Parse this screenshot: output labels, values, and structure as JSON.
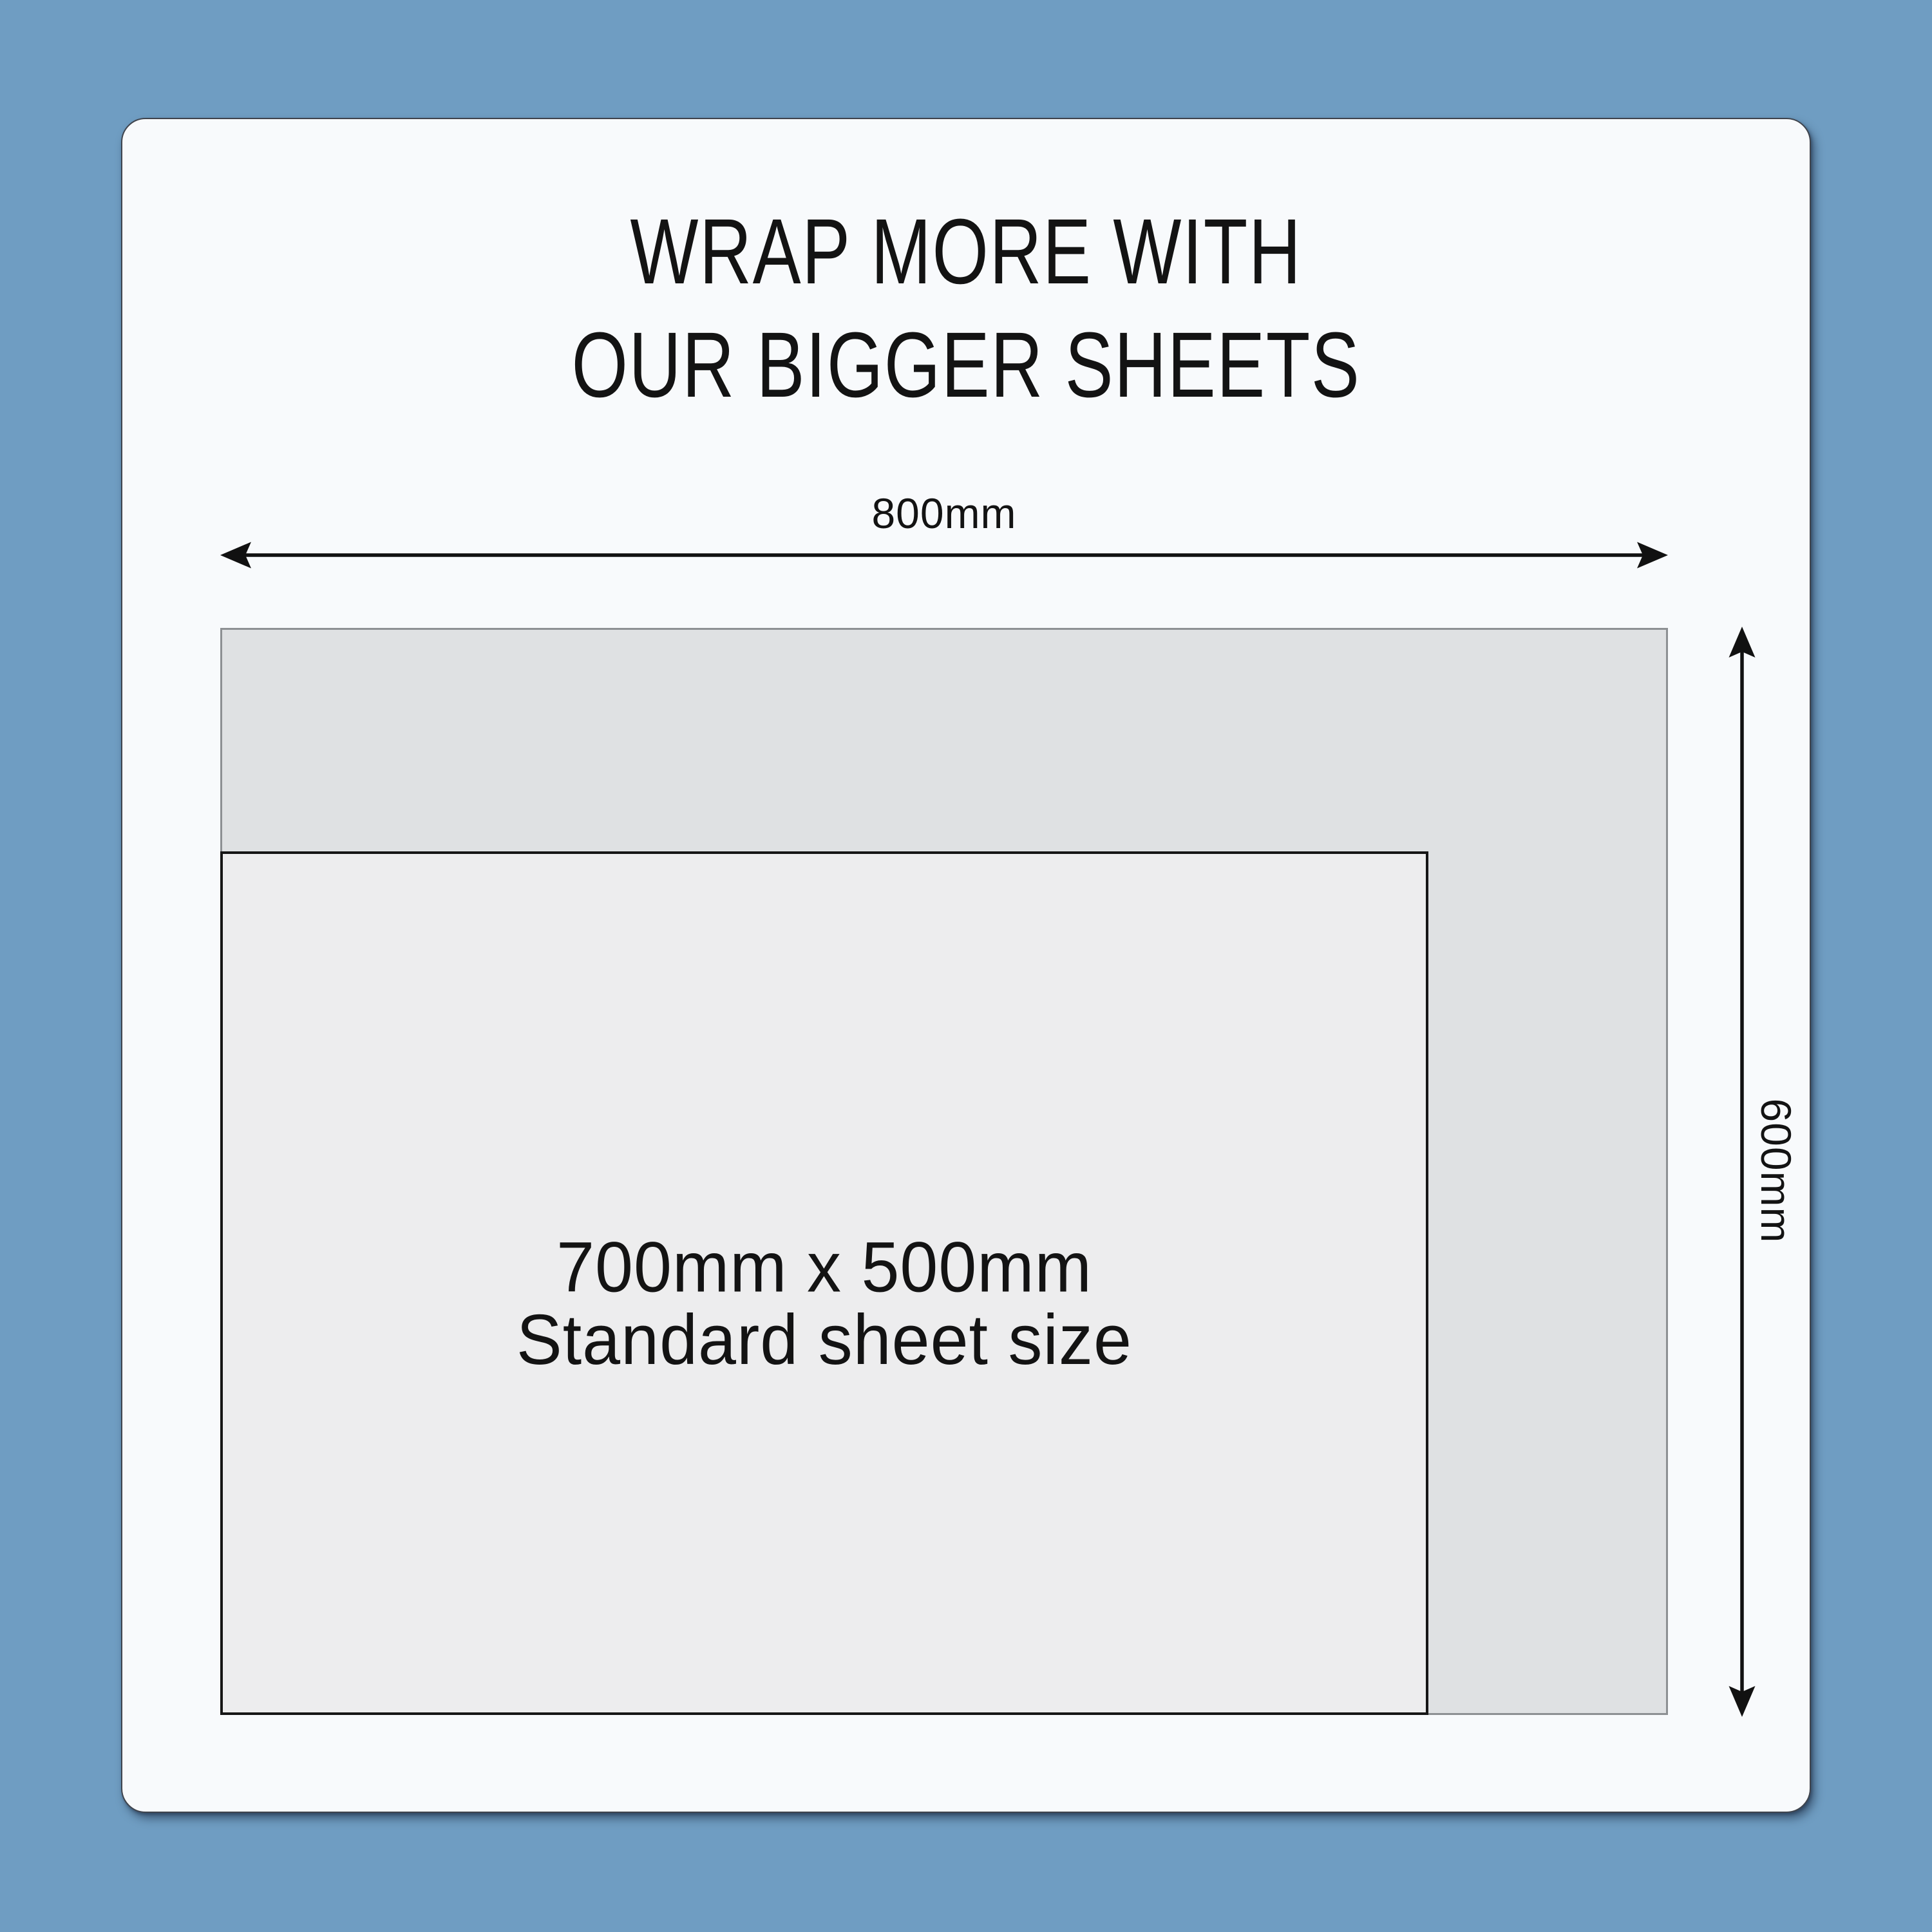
{
  "title": {
    "line1": "WRAP MORE WITH",
    "line2": "OUR BIGGER SHEETS"
  },
  "dimensions": {
    "width_label": "800mm",
    "height_label": "600mm"
  },
  "big_sheet": {
    "width_mm": "800",
    "height_mm": "600"
  },
  "standard_sheet": {
    "line1": "700mm x 500mm",
    "line2": "Standard sheet size"
  },
  "icons": {
    "horizontal_arrow": "double-headed-horizontal-dimension-arrow",
    "vertical_arrow": "double-headed-vertical-dimension-arrow"
  },
  "theme": {
    "background_blue": "#6f9dc2",
    "card_background": "#f8fafc",
    "card_border": "#3f444d",
    "big_sheet_fill": "#dfe1e3",
    "big_sheet_border": "#8d9093",
    "standard_sheet_fill": "#ededee",
    "standard_sheet_border": "#161616",
    "text_color": "#131313",
    "arrow_color": "#111111"
  }
}
